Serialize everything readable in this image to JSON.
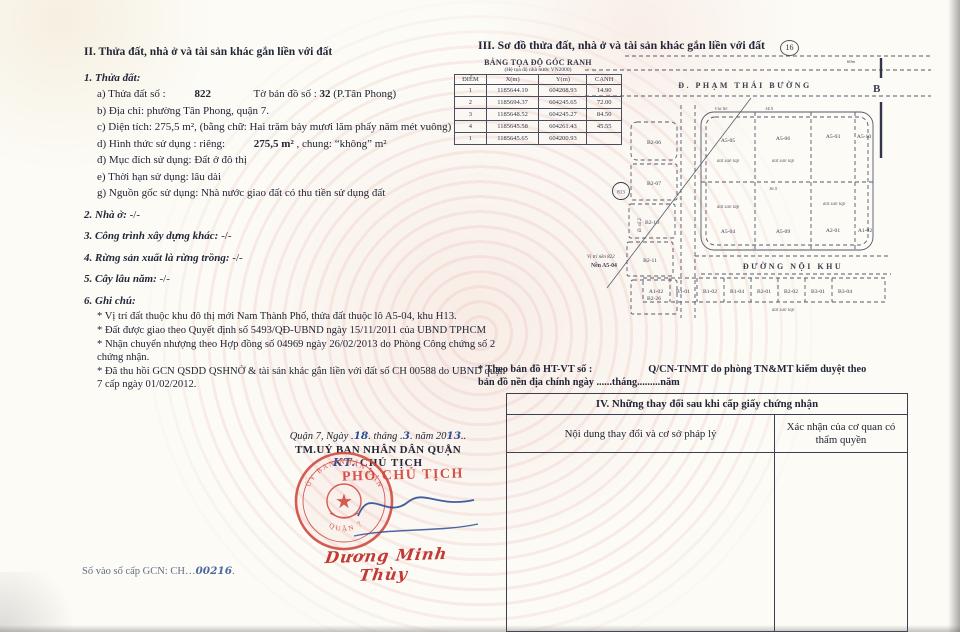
{
  "left": {
    "title": "II. Thửa đất, nhà ở và tài sản khác gắn liền với đất",
    "parcel": {
      "heading": "1. Thửa đất:",
      "a_label": "a) Thửa đất số :",
      "a_value": "822",
      "a_mid": "Tờ bản đồ số :",
      "a_value2": "32",
      "a_suffix": "(P.Tân Phong)",
      "b": "b) Địa chỉ:   phường Tân Phong, quận 7.",
      "c_pre": "c) Diện tích: 275,5 m²",
      "c_post": ", (bằng chữ: Hai trăm bảy mươi lăm phẩy năm mét vuông)",
      "d_pre": "d) Hình thức sử dụng : riêng:",
      "d_value": "275,5  m²",
      "d_post": ", chung: “không” m²",
      "dd": "đ) Mục đích sử dụng: Đất ở đô thị",
      "e": "e) Thời hạn sử dụng: lâu dài",
      "g": "g) Nguồn gốc sử dụng: Nhà nước giao đất có thu tiền sử dụng đất"
    },
    "house_label": "2. Nhà ở:",
    "house_value": "-/-",
    "construction_label": "3. Công trình xây dựng khác:",
    "construction_value": "-/-",
    "forest_label": "4. Rừng sản xuất là rừng trồng:",
    "forest_value": "-/-",
    "perennial_label": "5. Cây lâu năm:",
    "perennial_value": "-/-",
    "notes_heading": "6. Ghi chú:",
    "notes": [
      "* Vị trí đất thuộc khu đô thị mới Nam Thành Phố, thửa đất thuộc lô A5-04, khu H13.",
      "* Đất được giao theo Quyết định số 5493/QĐ-UBND ngày 15/11/2011 của UBND TPHCM",
      "* Nhận chuyển nhượng theo Hợp đồng số 04969 ngày 26/02/2013 do Phòng Công chứng số 2 chứng nhận.",
      "* Đã thu hồi GCN QSDD QSHNỞ & tài sản khác gắn liền với đất số CH 00588 do UBND quận 7 cấp ngày 01/02/2012."
    ],
    "signature": {
      "date_pre": "Quận 7, Ngày .",
      "day": "18",
      "date_m1": ". tháng .",
      "month": "3",
      "date_m2": ". năm 20",
      "year": "13",
      "date_suf": "..",
      "committee": "TM.UỶ BAN NHÂN DÂN QUẬN",
      "kt": "KT.",
      "chairman": "CHỦ TỊCH",
      "stamp_title": "PHÓ CHỦ TỊCH",
      "stamp_ring_top": "ỦY BAN NHÂN DÂN",
      "stamp_ring_bottom": "QUẬN 7",
      "signer": "Dương Minh Thùy"
    },
    "book_label": "Số vào sổ cấp GCN: CH…",
    "book_value": "00216",
    "book_suffix": "."
  },
  "right": {
    "title": "III. Sơ đồ thửa đất, nhà ở và tài sản khác gắn liền với đất",
    "badge": "16",
    "coord_table": {
      "title": "BẢNG TỌA ĐỘ GÓC RANH",
      "subtitle": "(Hệ tọa độ nhà nước VN2000)",
      "headers": [
        "ĐIỂM",
        "X(m)",
        "Y(m)",
        "CẠNH"
      ],
      "rows": [
        [
          "1",
          "1185644.19",
          "604208.93",
          "14.90"
        ],
        [
          "2",
          "1185694.37",
          "604245.65",
          "72.00"
        ],
        [
          "3",
          "1185648.52",
          "604245.27",
          "84.50"
        ],
        [
          "4",
          "1185645.58",
          "604261.43",
          "45.55"
        ],
        [
          "1",
          "1185645.65",
          "604200.93",
          ""
        ]
      ]
    },
    "map": {
      "street_top": "Đ. PHẠM THÁI BƯỜNG",
      "street_top_dim": "60m",
      "marker_b": "B",
      "road_inner": "ĐƯỜNG NỘI KHU",
      "badge": "813",
      "callout_line1": "Vị trí nền 822",
      "callout_line2": "Nền A5-04",
      "fill_label": "đất san lấp",
      "sidewalk": "Vỉa hè",
      "street_left": "Đ. số 2",
      "dim_top": "14.5",
      "dim_mid": "16.5",
      "lots_left": [
        "B2-06",
        "B2-07",
        "B2-10",
        "B2-11",
        "B2-26"
      ],
      "lots_top": [
        "A5-05",
        "A5-06",
        "A5-03",
        "A5-10"
      ],
      "lots_mid": [
        "A5-04",
        "A5-09",
        "A2-01",
        "A1-02"
      ],
      "lots_bottom": [
        "A1-02",
        "B1-01",
        "B1-02",
        "B1-04",
        "B2-01",
        "B2-02",
        "B3-01",
        "B3-04"
      ]
    },
    "map_note_1": "* Theo bản đồ HT-VT số :",
    "map_note_2": "Q/CN-TNMT do phòng TN&MT kiểm duyệt  theo",
    "map_note_3": "bản đồ nền địa chính ngày ......tháng.........năm",
    "changes_table": {
      "title": "IV. Những thay đổi sau khi cấp giấy chứng nhận",
      "col1": "Nội dung thay đổi và cơ sở pháp lý",
      "col2": "Xác nhận của cơ quan có thẩm quyền"
    }
  }
}
